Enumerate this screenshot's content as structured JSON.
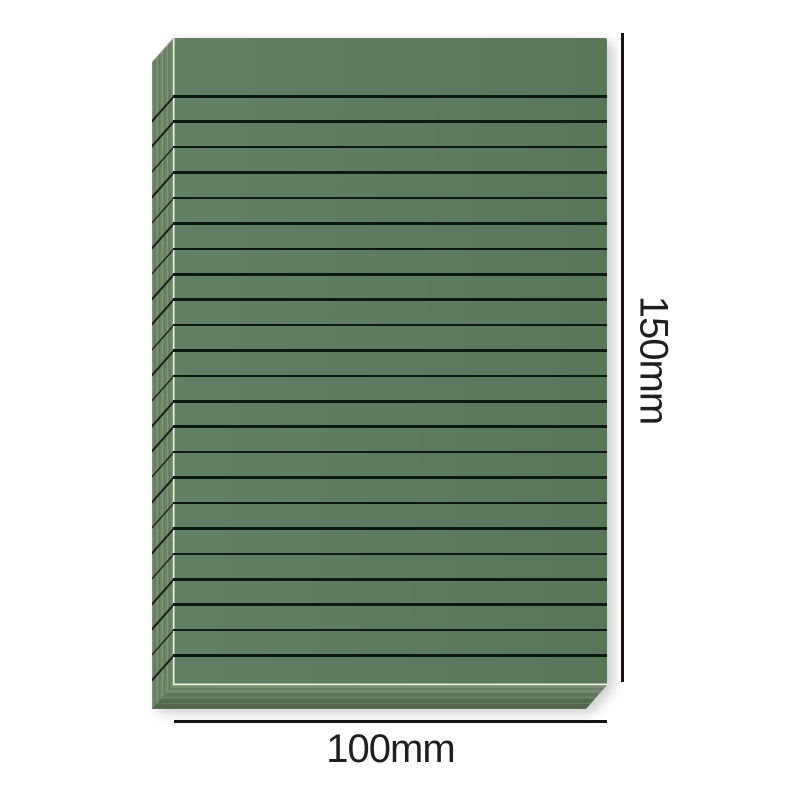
{
  "image": {
    "type": "product-dimension-diagram",
    "subject": "green lined note pad"
  },
  "theme": {
    "background": "#ffffff",
    "pad_front": "#5d7a5e",
    "pad_side": "#6f8568",
    "pad_bottom_light": "#7e9177",
    "pad_bottom_dark": "#4f654b",
    "rule_line": "#0d1811",
    "dimension_line": "#151515",
    "dimension_text": "#1f1f1f",
    "edge_highlight": "#eef2e2"
  },
  "product": {
    "rule_line_count": 23
  },
  "dimensions": {
    "height": {
      "label": "150mm"
    },
    "width": {
      "label": "100mm"
    }
  }
}
